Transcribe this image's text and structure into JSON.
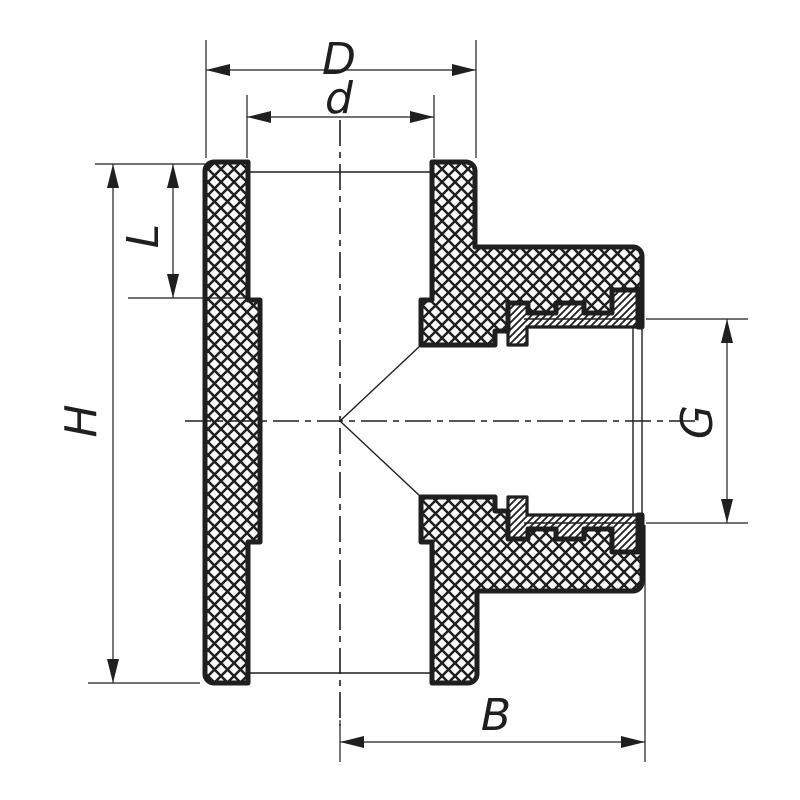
{
  "drawing": {
    "type": "technical-sectional-drawing",
    "subject": "tee pipe fitting with female threaded metal insert, cross-section view",
    "background_color": "#ffffff",
    "line_color": "#1f1f1f",
    "labels": {
      "outer_diameter": "D",
      "socket_inner_diameter": "d",
      "socket_depth": "L",
      "body_height": "H",
      "thread_size": "G",
      "branch_length": "B"
    }
  }
}
